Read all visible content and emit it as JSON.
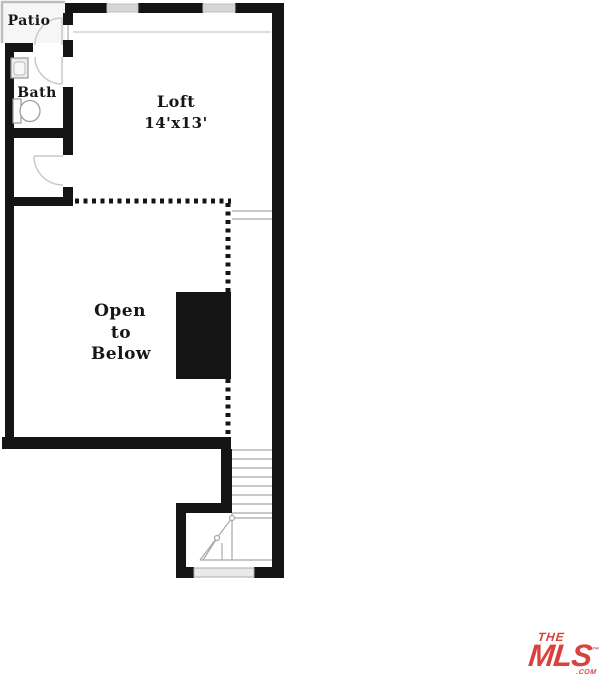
{
  "background": "#ffffff",
  "floorplan": {
    "labels": {
      "patio": "Patio",
      "bath": "Bath",
      "loft": "Loft",
      "loft_dimensions": "14'x13'",
      "open_line1": "Open",
      "open_line2": "to",
      "open_line3": "Below"
    },
    "features": {
      "stairs": "staircase-with-winders",
      "railing": "dotted-open-to-below-railing",
      "chimney": "solid-chimney-mass",
      "sink": "bathroom-sink",
      "toilet": "toilet",
      "doors": "swing-doors",
      "windows": "top-wall-windows",
      "threshold": "entry-threshold"
    },
    "colors": {
      "wall": "#141414",
      "window": "#d6d6d6",
      "stair_line": "#a8a8a8",
      "door_swing": "#c9c9c9",
      "label_text": "#161616",
      "patio_fill": "#f6f6f6"
    }
  },
  "logo": {
    "the": "THE",
    "mls": "MLS",
    "trademark": "™",
    "com": ".COM",
    "color": "#d9423c"
  }
}
